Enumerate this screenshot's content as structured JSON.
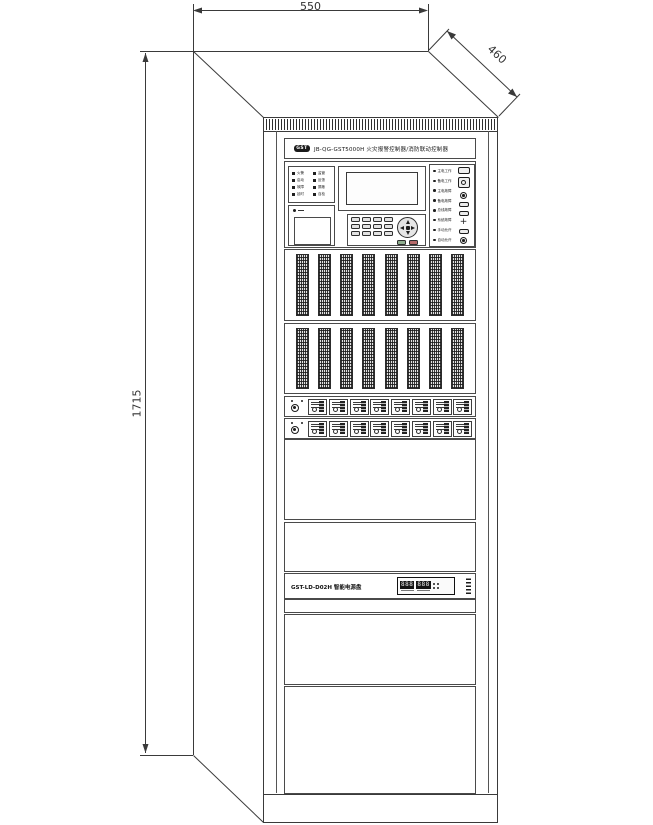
{
  "drawing": {
    "dim_width": "550",
    "dim_depth": "460",
    "dim_height": "1715"
  },
  "colors": {
    "line": "#3a3a3a",
    "dark": "#1c1c1c",
    "key_green": "#8fae8f",
    "key_red": "#b66a6a"
  },
  "cabinet": {
    "header": {
      "logo": "GST",
      "title": "JB-QG-GST5000H 火灾报警控制器/消防联动控制器"
    },
    "control_panel": {
      "status_leds": [
        "火警",
        "监管",
        "启动",
        "反馈",
        "故障",
        "屏蔽",
        "延时",
        "自检"
      ],
      "right_leds": [
        "主电工作",
        "备电工作",
        "主电故障",
        "备电故障",
        "总线故障",
        "系统故障",
        "手动允许",
        "自动允许"
      ],
      "plus_mark": "+",
      "keypad_keys": 12
    },
    "loop_rows": {
      "rows": 2,
      "strips_per_row": 8
    },
    "module_rows": {
      "rows": 2,
      "modules_per_row": 8
    },
    "power_panel": {
      "label": "GST-LD-D02H 智能电源盘",
      "display_left": "888",
      "display_right": "888",
      "led_count": 4
    }
  }
}
